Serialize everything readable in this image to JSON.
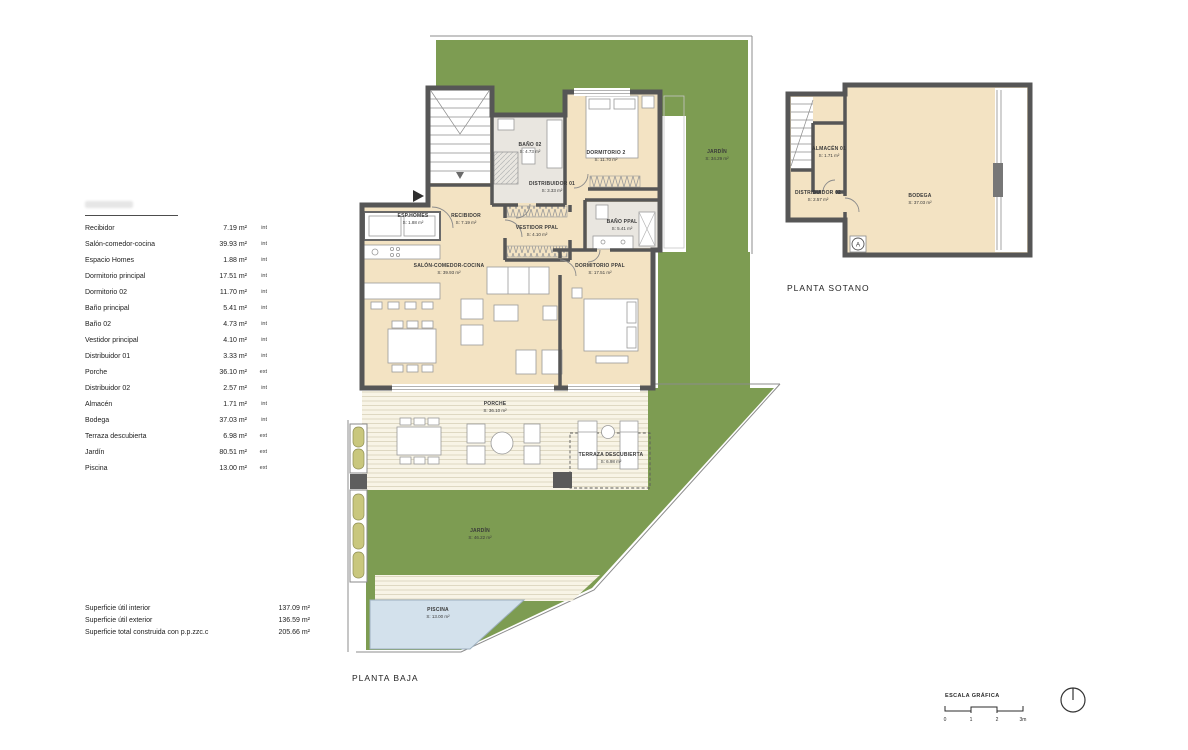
{
  "table": {
    "rows": [
      {
        "label": "Recibidor",
        "value": "7.19 m²",
        "type": "int"
      },
      {
        "label": "Salón-comedor-cocina",
        "value": "39.93 m²",
        "type": "int"
      },
      {
        "label": "Espacio Homes",
        "value": "1.88 m²",
        "type": "int"
      },
      {
        "label": "Dormitorio principal",
        "value": "17.51 m²",
        "type": "int"
      },
      {
        "label": "Dormitorio 02",
        "value": "11.70 m²",
        "type": "int"
      },
      {
        "label": "Baño principal",
        "value": "5.41 m²",
        "type": "int"
      },
      {
        "label": "Baño 02",
        "value": "4.73 m²",
        "type": "int"
      },
      {
        "label": "Vestidor principal",
        "value": "4.10 m²",
        "type": "int"
      },
      {
        "label": "Distribuidor 01",
        "value": "3.33 m²",
        "type": "int"
      },
      {
        "label": "Porche",
        "value": "36.10 m²",
        "type": "ext"
      },
      {
        "label": "Distribuidor 02",
        "value": "2.57 m²",
        "type": "int"
      },
      {
        "label": "Almacén",
        "value": "1.71 m²",
        "type": "int"
      },
      {
        "label": "Bodega",
        "value": "37.03 m²",
        "type": "int"
      },
      {
        "label": "Terraza descubierta",
        "value": "6.98 m²",
        "type": "ext"
      },
      {
        "label": "Jardín",
        "value": "80.51 m²",
        "type": "ext"
      },
      {
        "label": "Piscina",
        "value": "13.00 m²",
        "type": "ext"
      }
    ]
  },
  "summary": {
    "rows": [
      {
        "label": "Superficie útil interior",
        "value": "137.09 m²"
      },
      {
        "label": "Superficie útil exterior",
        "value": "136.59 m²"
      },
      {
        "label": "Superficie total construida con p.p.zzc.c",
        "value": "205.66 m²"
      }
    ]
  },
  "ground": {
    "title": "PLANTA BAJA",
    "rooms": {
      "recibidor": {
        "n": "RECIBIDOR",
        "a": "S: 7.19 m²"
      },
      "espHomes": {
        "n": "ESP.HOMES",
        "a": "S: 1.88 m²"
      },
      "salon": {
        "n": "SALÓN-COMEDOR-COCINA",
        "a": "S: 39.93 m²"
      },
      "dorm2": {
        "n": "DORMITORIO 2",
        "a": "S: 11.70 m²"
      },
      "bano02": {
        "n": "BAÑO 02",
        "a": "S: 4.73 m²"
      },
      "dist01": {
        "n": "DISTRIBUIDOR 01",
        "a": "S: 3.33 m²"
      },
      "vestidor": {
        "n": "VESTIDOR PPAL",
        "a": "S: 4.10 m²"
      },
      "banoPpal": {
        "n": "BAÑO PPAL",
        "a": "S: 5.41 m²"
      },
      "dormPpal": {
        "n": "DORMITORIO PPAL",
        "a": "S: 17.51 m²"
      },
      "porche": {
        "n": "PORCHE",
        "a": "S: 36.10 m²"
      },
      "terraza": {
        "n": "TERRAZA DESCUBIERTA",
        "a": "S: 6.98 m²"
      },
      "jardinSide": {
        "n": "JARDÍN",
        "a": "S: 34.29 m²"
      },
      "jardinMain": {
        "n": "JARDÍN",
        "a": "S: 46.22 m²"
      },
      "piscina": {
        "n": "PISCINA",
        "a": "S: 13.00 m²"
      }
    }
  },
  "basement": {
    "title": "PLANTA SOTANO",
    "marker": "A",
    "rooms": {
      "almacen": {
        "n": "ALMACÉN 01",
        "a": "S: 1.71 m²"
      },
      "dist02": {
        "n": "DISTRIBUIDOR 02",
        "a": "S: 2.57 m²"
      },
      "bodega": {
        "n": "BODEGA",
        "a": "S: 37.03 m²"
      }
    }
  },
  "scale": {
    "title": "ESCALA GRÁFICA",
    "ticks": [
      "0",
      "1",
      "2",
      "3m"
    ]
  },
  "colors": {
    "garden": "#7d9c52",
    "interior": "#f3e3c3",
    "wall": "#565656",
    "pool": "#d3e1ec",
    "planter": "#c9c77d"
  }
}
